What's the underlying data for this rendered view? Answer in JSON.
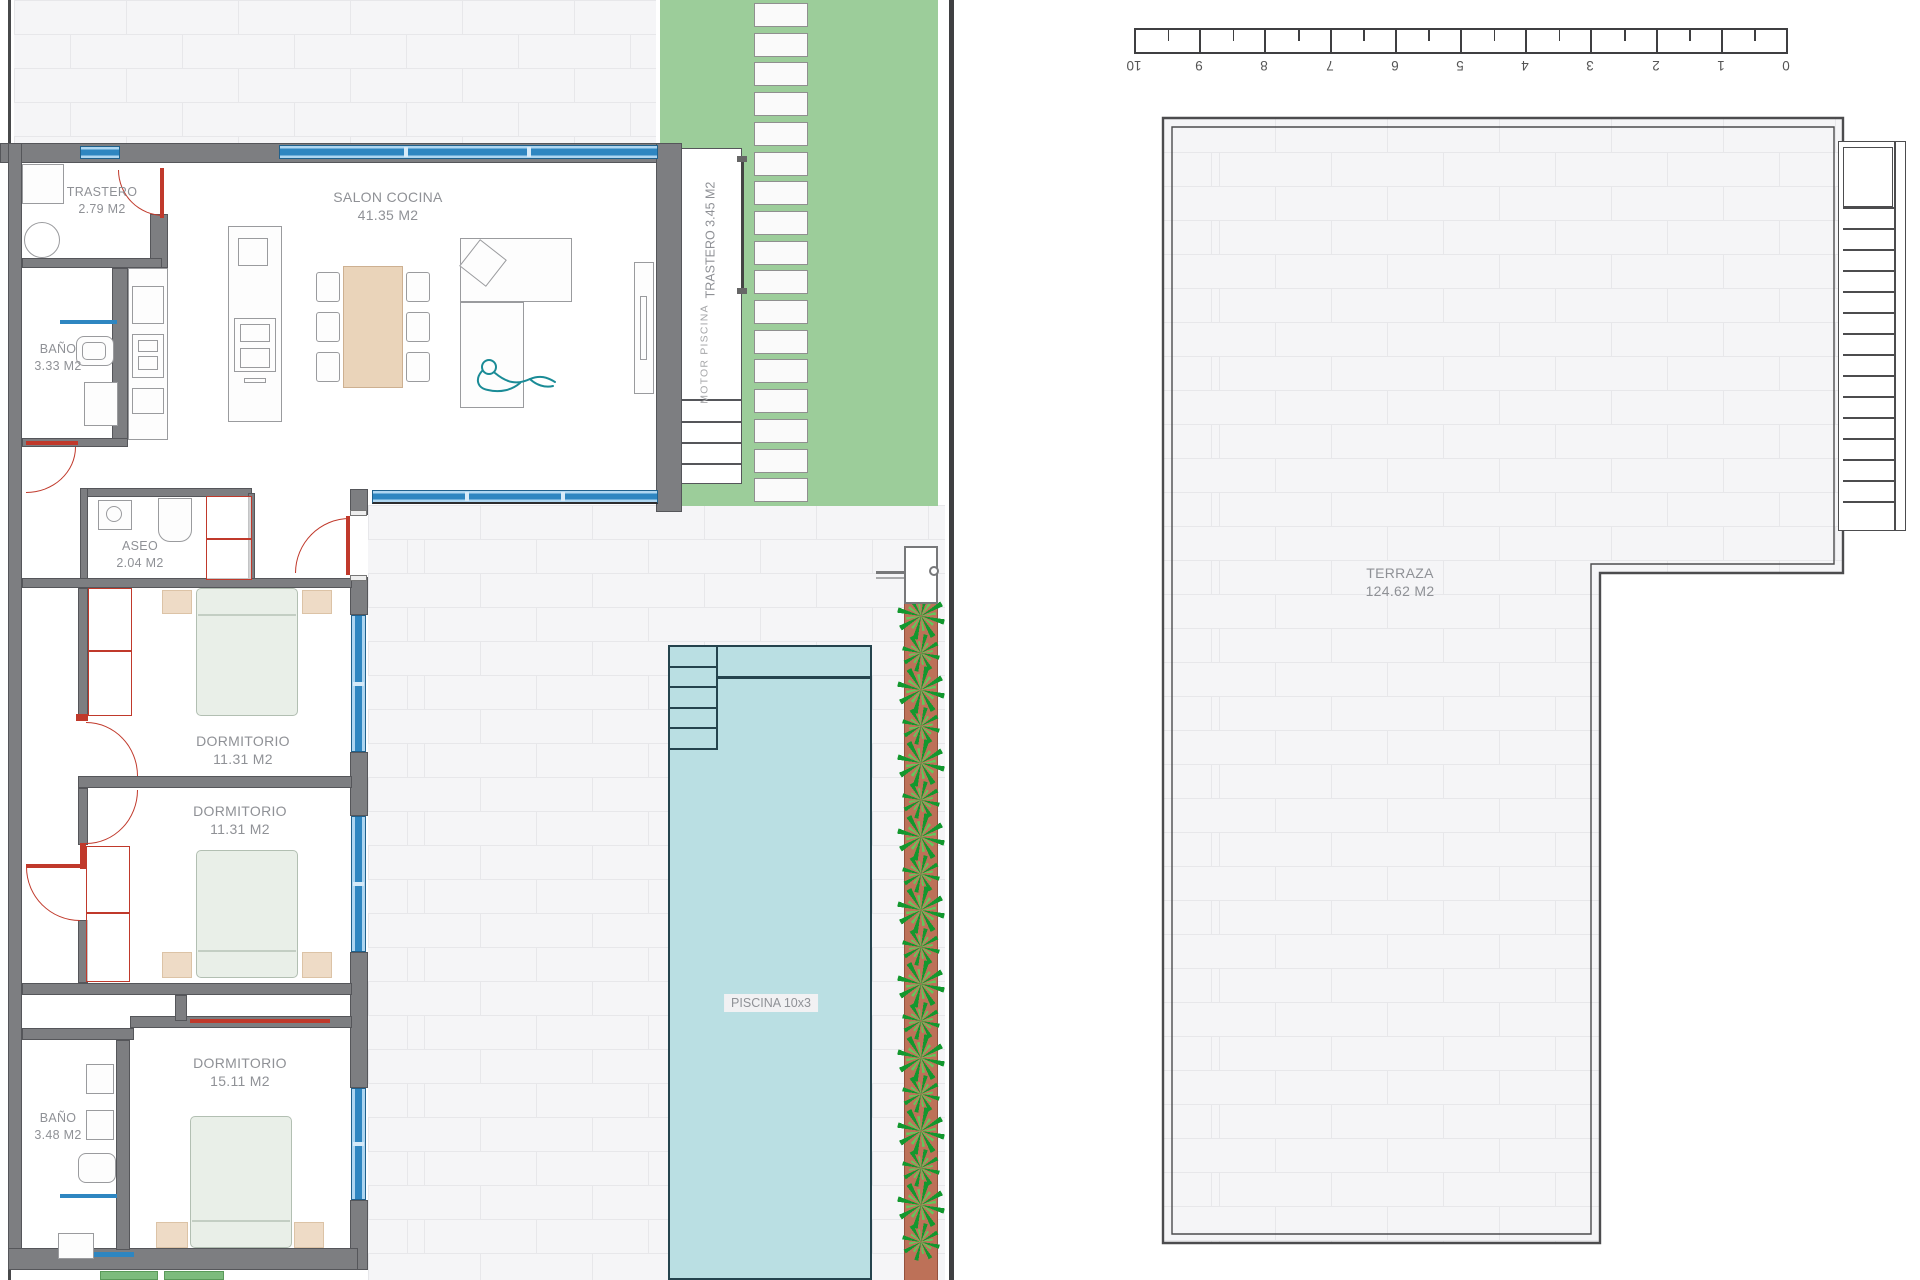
{
  "rooms": {
    "trastero_int": {
      "name": "TRASTERO",
      "area": "2.79 M2"
    },
    "salon": {
      "name": "SALON COCINA",
      "area": "41.35 M2"
    },
    "bano1": {
      "name": "BAÑO",
      "area": "3.33 M2"
    },
    "aseo": {
      "name": "ASEO",
      "area": "2.04 M2"
    },
    "dorm1": {
      "name": "DORMITORIO",
      "area": "11.31 M2"
    },
    "dorm2": {
      "name": "DORMITORIO",
      "area": "11.31 M2"
    },
    "dorm3": {
      "name": "DORMITORIO",
      "area": "15.11 M2"
    },
    "bano2": {
      "name": "BAÑO",
      "area": "3.48 M2"
    },
    "trastero_ext": {
      "name": "TRASTERO",
      "area": "3.45 M2"
    },
    "motor": {
      "label": "MOTOR  PISCINA"
    },
    "piscina": {
      "label": "PISCINA 10x3"
    },
    "terraza": {
      "name": "TERRAZA",
      "area": "124.62 M2"
    }
  },
  "ruler": {
    "numbers": [
      "10",
      "9",
      "8",
      "7",
      "6",
      "5",
      "4",
      "3",
      "2",
      "1",
      "0"
    ]
  },
  "colors": {
    "garden": "#9ccd9a",
    "planter": "#bd7158",
    "pool_fill": "#badfe3",
    "pool_border": "#24434d",
    "wall": "#7d7e81",
    "window_blue": "#2e86c1",
    "door_red": "#c0392b",
    "paving_tile": "#f5f5f7",
    "paving_joint": "#e7e7ea",
    "label_gray": "#8f9196"
  }
}
